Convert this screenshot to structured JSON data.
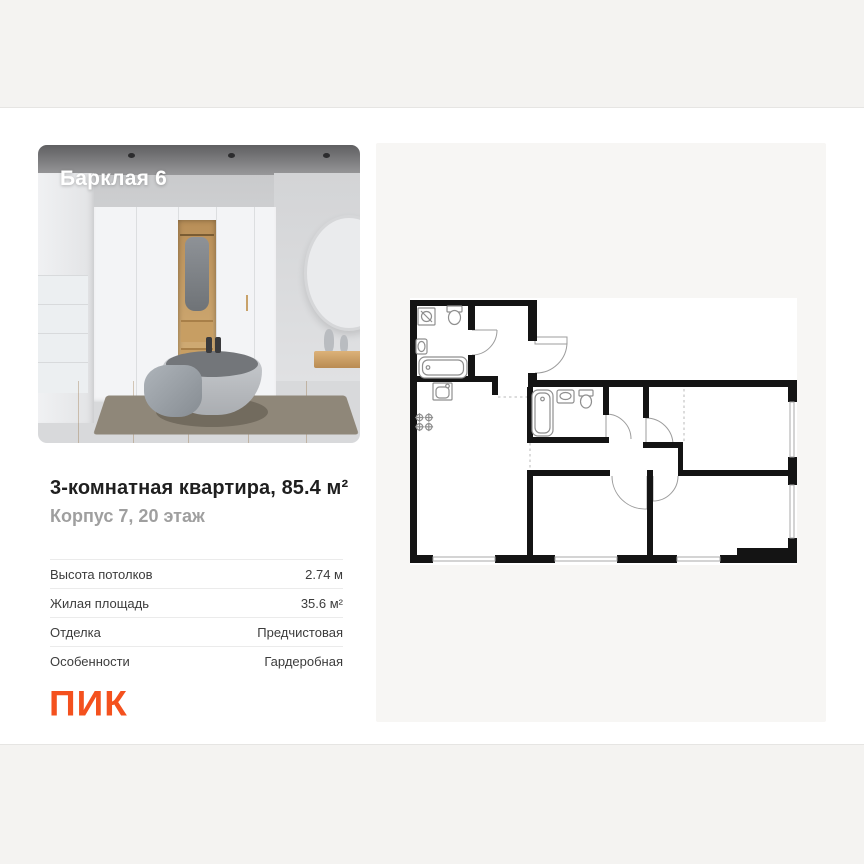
{
  "photo_card": {
    "project_label": "Барклая 6"
  },
  "listing": {
    "title": "3-комнатная квартира, 85.4 м²",
    "subtitle": "Корпус 7, 20 этаж",
    "specs": [
      {
        "label": "Высота потолков",
        "value": "2.74 м"
      },
      {
        "label": "Жилая площадь",
        "value": "35.6 м²"
      },
      {
        "label": "Отделка",
        "value": "Предчистовая"
      },
      {
        "label": "Особенности",
        "value": "Гардеробная"
      }
    ]
  },
  "branding": {
    "developer": "ПИК",
    "brand_color": "#F4511E"
  },
  "floorplan": {
    "kind": "apartment-floor-plan"
  }
}
